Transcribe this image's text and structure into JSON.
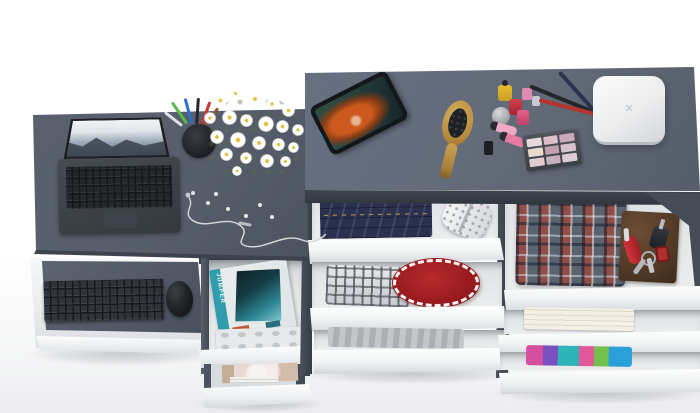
{
  "scene": {
    "type": "3d-product-render",
    "description": "Overhead 3D render of a graphite-and-white desk and dresser combo: laptop, pencil cup, daisy bouquet and earphones on the desk; tablet, hairbrush, cosmetics and a white keepsake box on the dresser; pull-out keyboard shelf with keyboard and mouse; open drawers holding magazines, an organizer tray, folded jeans, plaid shirts, a red round garment, gray fabric, a towel, colorful clothes, a leather notebook, pocket knife and keys"
  },
  "palette": {
    "background": "#ffffff",
    "desk_top": "#5a616e",
    "dresser_top": "#667080",
    "panel_dark": "#3f4650",
    "drawer_front": "#f5f6f8",
    "drawer_interior": "#e7e9eb",
    "keyboard_black": "#30343a",
    "laptop_gray": "#3c4147",
    "magazine_teal": "#2f9dac",
    "denim_blue": "#2a3150",
    "accent_red": "#a5201f",
    "wood_tan": "#c49a4a",
    "notebook_brown": "#57402c",
    "flower_center": "#e2c23c"
  },
  "texts": {
    "magazine_title": "JUMPER",
    "box_emblem": "✕"
  }
}
